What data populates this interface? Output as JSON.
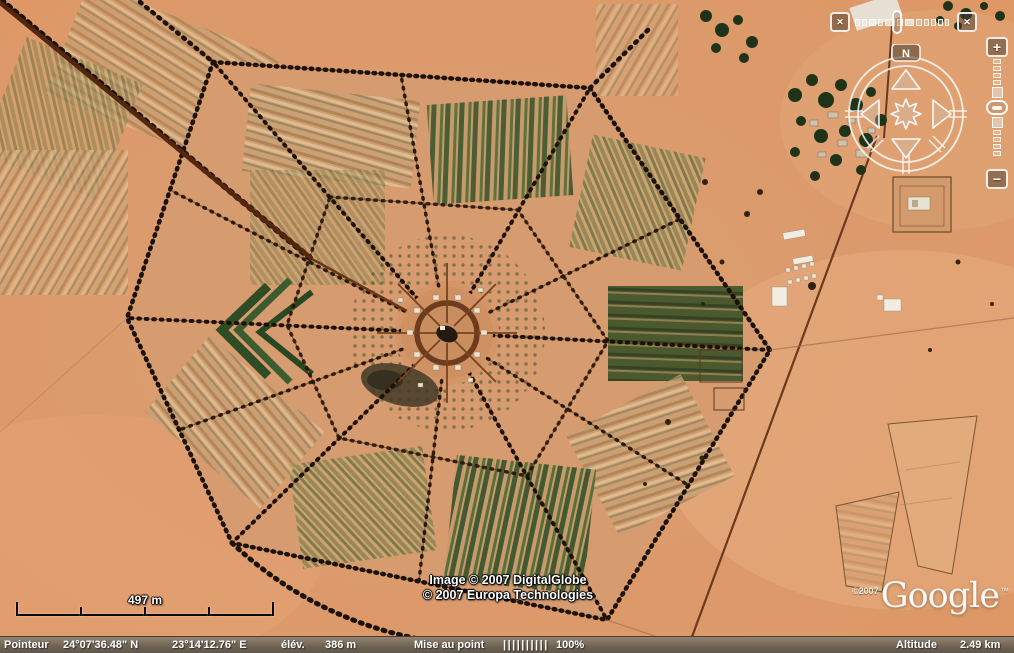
{
  "time_slider": {
    "left_button_icon": "✕",
    "right_button_icon": "✕"
  },
  "compass": {
    "north_label": "N"
  },
  "zoom_slider": {
    "zoom_in_label": "+",
    "zoom_out_label": "−"
  },
  "scale_bar": {
    "label": "497 m"
  },
  "attribution": {
    "line1": "Image © 2007 DigitalGlobe",
    "line2": "© 2007 Europa Technologies"
  },
  "logo": {
    "copyright": "©2007",
    "brand": "Google",
    "trademark": "™"
  },
  "status_bar": {
    "pointer_label": "Pointeur",
    "latitude": "24°07'36.48\" N",
    "longitude": "23°14'12.76\" E",
    "elevation_label": "élév.",
    "elevation_value": "386 m",
    "streaming_label": "Mise au point",
    "streaming_bars": "||||||||||",
    "streaming_percent": "100%",
    "altitude_label": "Altitude",
    "altitude_value": "2.49 km"
  },
  "colors": {
    "desert_sand": "#dc9a6c",
    "tree_line": "#1b1108",
    "vegetation_row": "#33522a",
    "main_road": "#54260e",
    "status_bar_bg": "#6e6253",
    "ui_outline": "rgba(255,255,255,0.88)"
  }
}
